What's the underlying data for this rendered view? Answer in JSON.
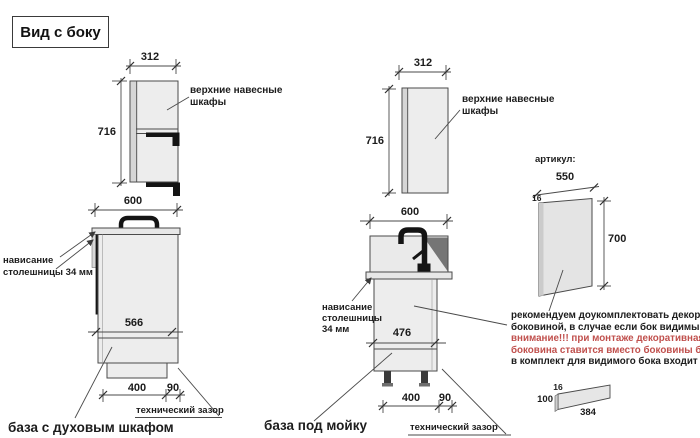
{
  "title": "Вид с боку",
  "views": {
    "oven": {
      "upper": {
        "width_mm": "312",
        "height_mm": "716",
        "label_lines": [
          "верхние навесные",
          "шкафы"
        ]
      },
      "base": {
        "top_width_mm": "600",
        "overhang_lines": [
          "нависание",
          "столешницы 34 мм"
        ],
        "depth_mm": "566",
        "bottom_width_mm": "400",
        "gap_mm": "90",
        "gap_label": "технический зазор",
        "name": "база с духовым шкафом"
      }
    },
    "sink": {
      "upper": {
        "width_mm": "312",
        "height_mm": "716",
        "label_lines": [
          "верхние навесные",
          "шкафы"
        ]
      },
      "base": {
        "top_width_mm": "600",
        "overhang_lines": [
          "нависание",
          "столешницы",
          "34 мм"
        ],
        "depth_mm": "476",
        "bottom_width_mm": "400",
        "gap_mm": "90",
        "gap_label": "технический зазор",
        "name": "база под мойку"
      }
    }
  },
  "panel_section": {
    "heading": "артикул:",
    "width_mm": "550",
    "thickness_mm": "16",
    "height_mm": "700",
    "note_lines": [
      "рекомендуем доукомплектовать декоративной",
      "боковиной, в случае если бок видимый",
      "внимание!!! при монтаже декоративная",
      "боковина ставится вместо боковины базы лдсп",
      "в комплект для видимого бока входит цоколь:"
    ],
    "plinth": {
      "thickness_mm": "16",
      "height_mm": "100",
      "length_mm": "384"
    }
  },
  "colors": {
    "warning_text": "#c0504d",
    "line": "#4a4a4a",
    "cabinet_fill": "#ededed",
    "black_parts": "#141414"
  }
}
